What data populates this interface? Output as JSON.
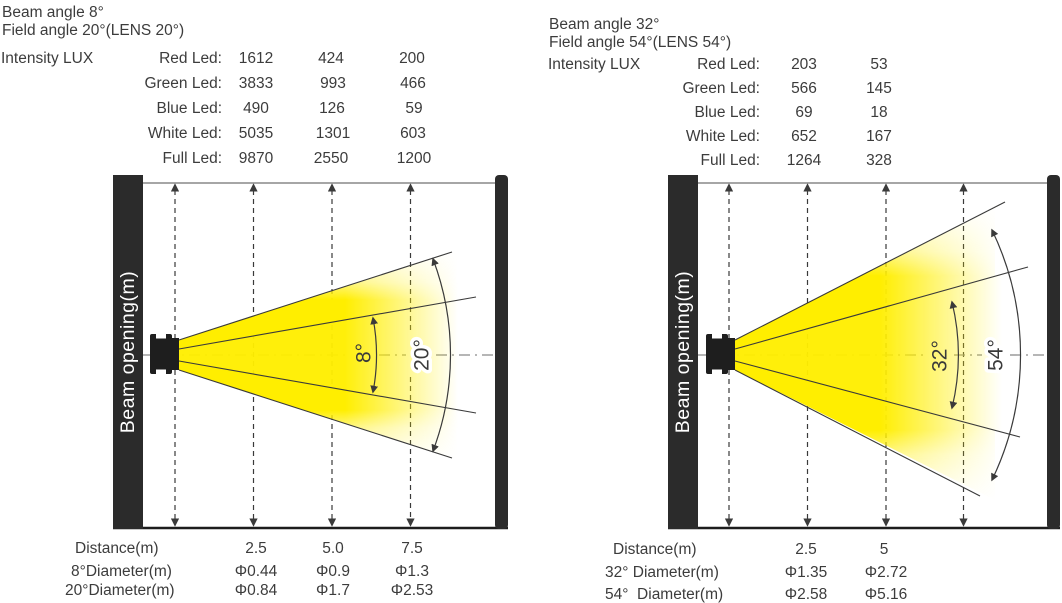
{
  "panels": [
    {
      "beam_angle": "Beam angle 8°",
      "field_angle": "Field angle 20°(LENS 20°)",
      "intensity_header": "Intensity LUX",
      "intensity_rows": [
        {
          "label": "Red Led:",
          "values": [
            "1612",
            "424",
            "200"
          ]
        },
        {
          "label": "Green Led:",
          "values": [
            "3833",
            "993",
            "466"
          ]
        },
        {
          "label": "Blue Led:",
          "values": [
            "490",
            "126",
            "59"
          ]
        },
        {
          "label": "White Led:",
          "values": [
            "5035",
            "1301",
            "603"
          ]
        },
        {
          "label": "Full Led:",
          "values": [
            "9870",
            "2550",
            "1200"
          ]
        }
      ],
      "axis_label": "Beam opening(m)",
      "inner_angle_label": "8°",
      "outer_angle_label": "20°",
      "distance_label": "Distance(m)",
      "distance_values": [
        "2.5",
        "5.0",
        "7.5"
      ],
      "diameter_rows": [
        {
          "label": "8°Diameter(m)",
          "values": [
            "Φ0.44",
            "Φ0.9",
            "Φ1.3"
          ]
        },
        {
          "label": "20°Diameter(m)",
          "values": [
            "Φ0.84",
            "Φ1.7",
            "Φ2.53"
          ]
        }
      ]
    },
    {
      "beam_angle": "Beam angle 32°",
      "field_angle": "Field angle 54°(LENS 54°)",
      "intensity_header": "Intensity LUX",
      "intensity_rows": [
        {
          "label": "Red Led:",
          "values": [
            "203",
            "53"
          ]
        },
        {
          "label": "Green Led:",
          "values": [
            "566",
            "145"
          ]
        },
        {
          "label": "Blue Led:",
          "values": [
            "69",
            "18"
          ]
        },
        {
          "label": "White Led:",
          "values": [
            "652",
            "167"
          ]
        },
        {
          "label": "Full Led:",
          "values": [
            "1264",
            "328"
          ]
        }
      ],
      "axis_label": "Beam opening(m)",
      "inner_angle_label": "32°",
      "outer_angle_label": "54°",
      "distance_label": "Distance(m)",
      "distance_values": [
        "2.5",
        "5"
      ],
      "diameter_rows": [
        {
          "label": "32° Diameter(m)",
          "values": [
            "Φ1.35",
            "Φ2.72"
          ]
        },
        {
          "label": "54°  Diameter(m)",
          "values": [
            "Φ2.58",
            "Φ5.16"
          ]
        }
      ]
    }
  ],
  "colors": {
    "beam_yellow": "#FFEE00",
    "wall_black": "#2B2B2B",
    "line_gray": "#3A3A3A"
  }
}
